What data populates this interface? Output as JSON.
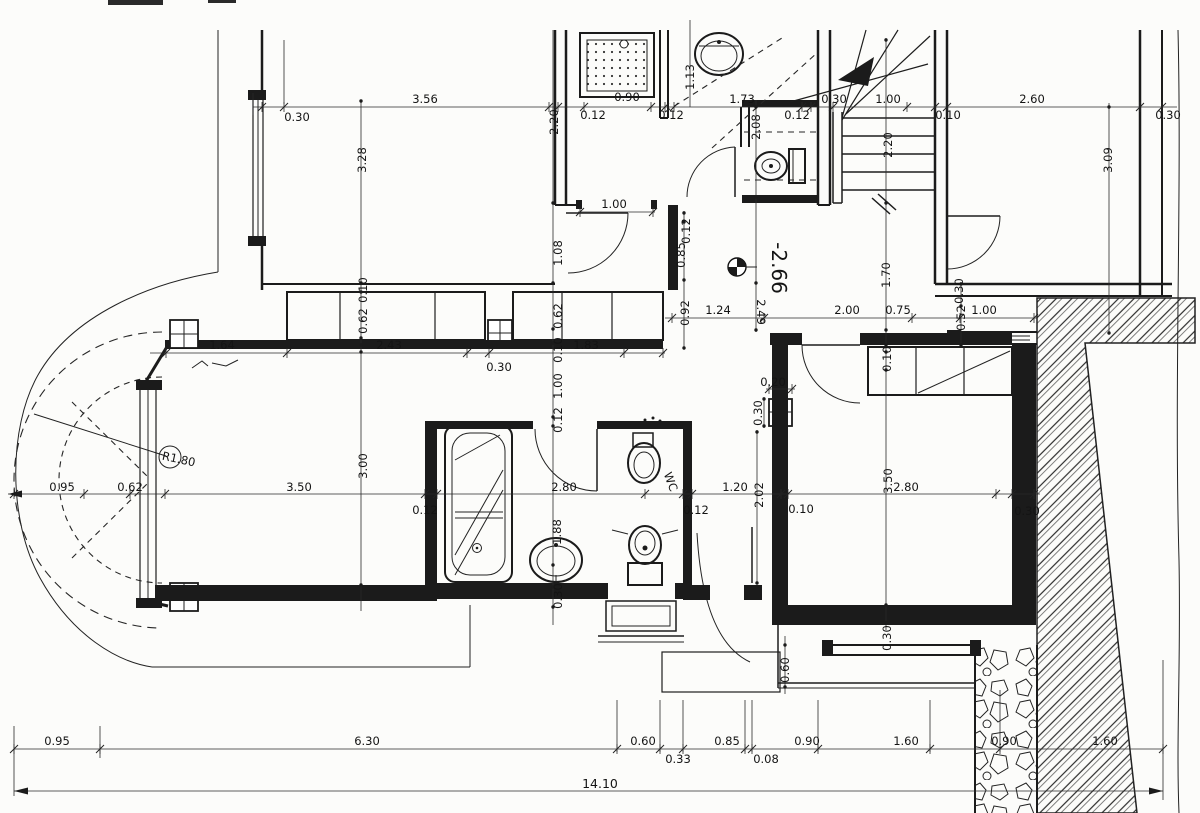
{
  "document": {
    "type": "Scanned architectural floor plan, basement level, dimensioned in meters",
    "level_marker": "-2.66",
    "overall_length": "14.10",
    "bay_radius_note": "R1.80",
    "room_annotation": "WC"
  },
  "dimension_chains": {
    "bottom_chain": [
      "0.95",
      "6.30",
      "0.60",
      "0.33",
      "0.85",
      "0.08",
      "0.90",
      "1.60",
      "0.90",
      "1.60"
    ],
    "bottom_total": "14.10",
    "top_chain": [
      "0.30",
      "3.56",
      "0.12",
      "0.90",
      "1.13",
      "1.73",
      "0.12",
      "0.30",
      "1.00",
      "0.10",
      "2.60",
      "0.30"
    ]
  },
  "dim_labels": [
    {
      "t": "3.56",
      "x": 425,
      "y": 103
    },
    {
      "t": "0.30",
      "x": 297,
      "y": 121
    },
    {
      "t": "0.12",
      "x": 593,
      "y": 119
    },
    {
      "t": "0.90",
      "x": 627,
      "y": 101
    },
    {
      "t": "1.73",
      "x": 742,
      "y": 103
    },
    {
      "t": "0.12",
      "x": 671,
      "y": 119
    },
    {
      "t": "0.12",
      "x": 797,
      "y": 119
    },
    {
      "t": "0.30",
      "x": 834,
      "y": 103
    },
    {
      "t": "1.00",
      "x": 888,
      "y": 103
    },
    {
      "t": "0.10",
      "x": 948,
      "y": 119
    },
    {
      "t": "2.60",
      "x": 1032,
      "y": 103
    },
    {
      "t": "0.30",
      "x": 1168,
      "y": 119
    },
    {
      "t": "1.00",
      "x": 614,
      "y": 208
    },
    {
      "t": "1.24",
      "x": 718,
      "y": 314
    },
    {
      "t": "2.00",
      "x": 847,
      "y": 314
    },
    {
      "t": "0.75",
      "x": 898,
      "y": 314
    },
    {
      "t": "1.00",
      "x": 984,
      "y": 314
    },
    {
      "t": "0.20",
      "x": 773,
      "y": 386
    },
    {
      "t": "1.64",
      "x": 222,
      "y": 349
    },
    {
      "t": "2.43",
      "x": 389,
      "y": 349
    },
    {
      "t": "0.30",
      "x": 499,
      "y": 371
    },
    {
      "t": "1.83",
      "x": 586,
      "y": 349
    },
    {
      "t": "0.95",
      "x": 62,
      "y": 491
    },
    {
      "t": "0.62",
      "x": 130,
      "y": 491
    },
    {
      "t": "3.50",
      "x": 299,
      "y": 491
    },
    {
      "t": "0.12",
      "x": 425,
      "y": 514
    },
    {
      "t": "2.80",
      "x": 564,
      "y": 491
    },
    {
      "t": "0.12",
      "x": 696,
      "y": 514
    },
    {
      "t": "1.20",
      "x": 735,
      "y": 491
    },
    {
      "t": "0.10",
      "x": 801,
      "y": 513
    },
    {
      "t": "2.80",
      "x": 906,
      "y": 491
    },
    {
      "t": "0.30",
      "x": 1027,
      "y": 515
    },
    {
      "t": "0.95",
      "x": 57,
      "y": 745
    },
    {
      "t": "6.30",
      "x": 367,
      "y": 745
    },
    {
      "t": "0.60",
      "x": 643,
      "y": 745
    },
    {
      "t": "0.33",
      "x": 678,
      "y": 763
    },
    {
      "t": "0.85",
      "x": 727,
      "y": 745
    },
    {
      "t": "0.08",
      "x": 766,
      "y": 763
    },
    {
      "t": "0.90",
      "x": 807,
      "y": 745
    },
    {
      "t": "1.60",
      "x": 906,
      "y": 745
    },
    {
      "t": "0.90",
      "x": 1004,
      "y": 745
    },
    {
      "t": "1.60",
      "x": 1105,
      "y": 745
    },
    {
      "t": "14.10",
      "x": 600,
      "y": 788,
      "s": 12.5
    },
    {
      "t": "3.28",
      "x": 366,
      "y": 160,
      "r": -90
    },
    {
      "t": "2.20",
      "x": 558,
      "y": 122,
      "r": -90
    },
    {
      "t": "1.13",
      "x": 694,
      "y": 77,
      "r": -90
    },
    {
      "t": "2.08",
      "x": 760,
      "y": 127,
      "r": -90
    },
    {
      "t": "2.20",
      "x": 892,
      "y": 145,
      "r": -90
    },
    {
      "t": "3.09",
      "x": 1112,
      "y": 160,
      "r": -90
    },
    {
      "t": "0.12",
      "x": 690,
      "y": 231,
      "r": -90
    },
    {
      "t": "0.85",
      "x": 685,
      "y": 255,
      "r": -90
    },
    {
      "t": "1.08",
      "x": 562,
      "y": 253,
      "r": -90
    },
    {
      "t": "0.62",
      "x": 562,
      "y": 316,
      "r": -90
    },
    {
      "t": "0.10",
      "x": 562,
      "y": 350,
      "r": -90
    },
    {
      "t": "1.00",
      "x": 562,
      "y": 386,
      "r": -90
    },
    {
      "t": "0.12",
      "x": 562,
      "y": 420,
      "r": -90
    },
    {
      "t": "0.92",
      "x": 689,
      "y": 313,
      "r": -90
    },
    {
      "t": "1.70",
      "x": 890,
      "y": 275,
      "r": -90
    },
    {
      "t": "0.30",
      "x": 963,
      "y": 291,
      "r": -90
    },
    {
      "t": "0.52",
      "x": 965,
      "y": 318,
      "r": -90
    },
    {
      "t": "0.10",
      "x": 891,
      "y": 359,
      "r": -90
    },
    {
      "t": "0.30",
      "x": 762,
      "y": 413,
      "r": -90
    },
    {
      "t": "0.10",
      "x": 367,
      "y": 290,
      "r": -90
    },
    {
      "t": "0.62",
      "x": 367,
      "y": 321,
      "r": -90
    },
    {
      "t": "3.00",
      "x": 367,
      "y": 466,
      "r": -90
    },
    {
      "t": "1.88",
      "x": 561,
      "y": 532,
      "r": -90
    },
    {
      "t": "2.02",
      "x": 763,
      "y": 495,
      "r": -90
    },
    {
      "t": "3.50",
      "x": 892,
      "y": 481,
      "r": -90
    },
    {
      "t": "0.30",
      "x": 562,
      "y": 596,
      "r": -90
    },
    {
      "t": "0.30",
      "x": 891,
      "y": 638,
      "r": -90
    },
    {
      "t": "0.60",
      "x": 789,
      "y": 670,
      "r": -90
    },
    {
      "t": "-2.66",
      "x": 772,
      "y": 268,
      "r": 90,
      "s": 20
    },
    {
      "t": "2.49",
      "x": 757,
      "y": 312,
      "r": 90
    },
    {
      "t": "R1.80",
      "x": 178,
      "y": 463,
      "r": 12
    },
    {
      "t": "WC",
      "x": 667,
      "y": 483,
      "r": 70
    }
  ]
}
